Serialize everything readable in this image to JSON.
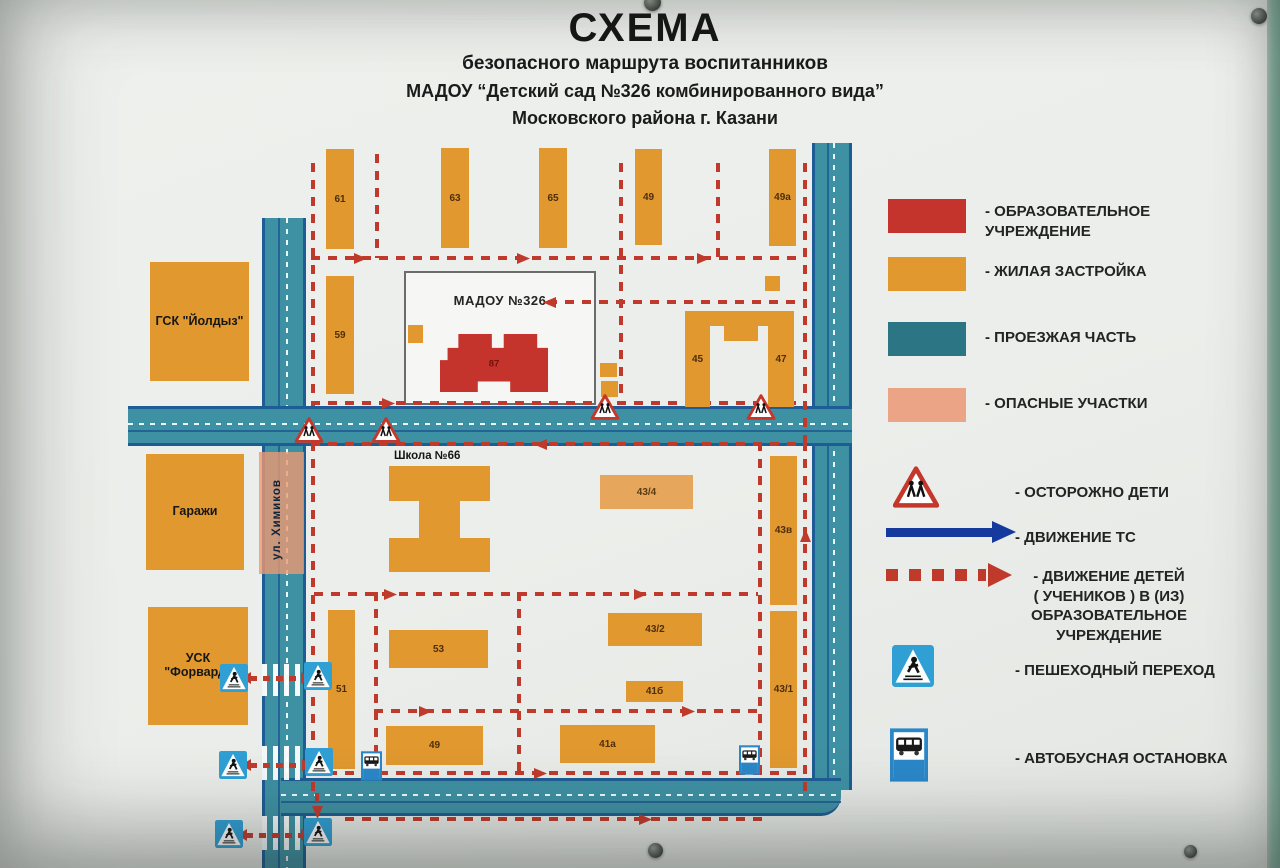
{
  "title": {
    "line1": "СХЕМА",
    "line2": "безопасного маршрута воспитанников",
    "line3": "МАДОУ “Детский сад №326 комбинированного вида”",
    "line4": "Московского района г. Казани"
  },
  "colors": {
    "education": "#c5342c",
    "residential": "#e0982f",
    "roadway": "#2b7584",
    "danger": "#eca487",
    "route_children": "#c03a2b",
    "vehicle_arrow": "#16399e",
    "road_fill": "#3e91a3",
    "road_edge": "#1d5c94",
    "sign_blue": "#2f9fd4"
  },
  "legend": {
    "items": [
      {
        "type": "swatch-education",
        "label": "- ОБРАЗОВАТЕЛЬНОЕ\nУЧРЕЖДЕНИЕ"
      },
      {
        "type": "swatch-residential",
        "label": "- ЖИЛАЯ ЗАСТРОЙКА"
      },
      {
        "type": "swatch-roadway",
        "label": "- ПРОЕЗЖАЯ ЧАСТЬ"
      },
      {
        "type": "swatch-danger",
        "label": "- ОПАСНЫЕ УЧАСТКИ"
      },
      {
        "type": "warn-sign",
        "label": "- ОСТОРОЖНО ДЕТИ"
      },
      {
        "type": "blue-arrow",
        "label": "- ДВИЖЕНИЕ ТС"
      },
      {
        "type": "red-dashed-arrow",
        "label": "- ДВИЖЕНИЕ ДЕТЕЙ\n( УЧЕНИКОВ ) В (ИЗ)\nОБРАЗОВАТЕЛЬНОЕ\nУЧРЕЖДЕНИЕ"
      },
      {
        "type": "pedestrian-sign",
        "label": "- ПЕШЕХОДНЫЙ ПЕРЕХОД"
      },
      {
        "type": "bus-sign",
        "label": "- АВТОБУСНАЯ ОСТАНОВКА"
      }
    ]
  },
  "map": {
    "street_label": "ул. Химиков",
    "madou_label": "МАДОУ №326",
    "madou_number": "87",
    "school_label": "Школа №66",
    "buildings": [
      {
        "label": "61",
        "x": 326,
        "y": 149,
        "w": 28,
        "h": 100
      },
      {
        "label": "63",
        "x": 441,
        "y": 148,
        "w": 28,
        "h": 100
      },
      {
        "label": "65",
        "x": 539,
        "y": 148,
        "w": 28,
        "h": 100
      },
      {
        "label": "49",
        "x": 635,
        "y": 149,
        "w": 27,
        "h": 96
      },
      {
        "label": "49а",
        "x": 769,
        "y": 149,
        "w": 27,
        "h": 97
      },
      {
        "label": "59",
        "x": 326,
        "y": 276,
        "w": 28,
        "h": 118
      },
      {
        "label": "45",
        "x": 685,
        "y": 311,
        "w": 25,
        "h": 96
      },
      {
        "label": "47",
        "x": 768,
        "y": 311,
        "w": 26,
        "h": 96
      },
      {
        "label": "",
        "x": 706,
        "y": 311,
        "w": 66,
        "h": 15
      },
      {
        "label": "",
        "x": 724,
        "y": 311,
        "w": 34,
        "h": 30
      },
      {
        "label": "ГСК \"Йолдыз\"",
        "x": 150,
        "y": 262,
        "w": 99,
        "h": 119,
        "kind": "big"
      },
      {
        "label": "Гаражи",
        "x": 146,
        "y": 454,
        "w": 98,
        "h": 116,
        "kind": "big"
      },
      {
        "label": "УСК \"Форвард\"",
        "x": 148,
        "y": 607,
        "w": 100,
        "h": 118,
        "kind": "big"
      },
      {
        "label": "",
        "x": 389,
        "y": 466,
        "w": 101,
        "h": 35
      },
      {
        "label": "",
        "x": 419,
        "y": 501,
        "w": 41,
        "h": 37
      },
      {
        "label": "",
        "x": 389,
        "y": 538,
        "w": 101,
        "h": 34
      },
      {
        "label": "43/4",
        "x": 600,
        "y": 475,
        "w": 93,
        "h": 34,
        "kind": "light"
      },
      {
        "label": "43в",
        "x": 770,
        "y": 456,
        "w": 27,
        "h": 149
      },
      {
        "label": "43/1",
        "x": 770,
        "y": 611,
        "w": 27,
        "h": 157
      },
      {
        "label": "51",
        "x": 328,
        "y": 610,
        "w": 27,
        "h": 159
      },
      {
        "label": "53",
        "x": 389,
        "y": 630,
        "w": 99,
        "h": 38
      },
      {
        "label": "49",
        "x": 386,
        "y": 726,
        "w": 97,
        "h": 39
      },
      {
        "label": "43/2",
        "x": 608,
        "y": 613,
        "w": 94,
        "h": 33
      },
      {
        "label": "41б",
        "x": 626,
        "y": 681,
        "w": 57,
        "h": 21
      },
      {
        "label": "41а",
        "x": 560,
        "y": 725,
        "w": 95,
        "h": 38
      },
      {
        "label": "",
        "x": 408,
        "y": 325,
        "w": 15,
        "h": 18
      },
      {
        "label": "",
        "x": 765,
        "y": 276,
        "w": 15,
        "h": 15
      },
      {
        "label": "",
        "x": 600,
        "y": 363,
        "w": 17,
        "h": 14
      },
      {
        "label": "",
        "x": 601,
        "y": 381,
        "w": 17,
        "h": 16
      }
    ],
    "routes": [
      {
        "d": "v",
        "x": 311,
        "y": 163,
        "len": 243
      },
      {
        "d": "v",
        "x": 375,
        "y": 154,
        "len": 104
      },
      {
        "d": "v",
        "x": 619,
        "y": 163,
        "len": 240
      },
      {
        "d": "v",
        "x": 716,
        "y": 163,
        "len": 95
      },
      {
        "d": "v",
        "x": 803,
        "y": 163,
        "len": 280
      },
      {
        "d": "h",
        "x": 311,
        "y": 256,
        "len": 493
      },
      {
        "d": "h",
        "x": 548,
        "y": 300,
        "len": 256
      },
      {
        "d": "h",
        "x": 311,
        "y": 401,
        "len": 493
      },
      {
        "d": "h",
        "x": 311,
        "y": 442,
        "len": 493
      },
      {
        "d": "v",
        "x": 311,
        "y": 442,
        "len": 352
      },
      {
        "d": "v",
        "x": 803,
        "y": 442,
        "len": 352
      },
      {
        "d": "v",
        "x": 758,
        "y": 442,
        "len": 330
      },
      {
        "d": "v",
        "x": 517,
        "y": 592,
        "len": 183
      },
      {
        "d": "v",
        "x": 374,
        "y": 592,
        "len": 181
      },
      {
        "d": "h",
        "x": 314,
        "y": 592,
        "len": 444
      },
      {
        "d": "h",
        "x": 374,
        "y": 709,
        "len": 384
      },
      {
        "d": "h",
        "x": 311,
        "y": 771,
        "len": 493
      },
      {
        "d": "h",
        "x": 345,
        "y": 817,
        "len": 420
      },
      {
        "d": "v",
        "x": 315,
        "y": 793,
        "len": 16
      }
    ],
    "route_arrows": [
      {
        "x": 360,
        "y": 258,
        "dir": "right"
      },
      {
        "x": 523,
        "y": 258,
        "dir": "right"
      },
      {
        "x": 703,
        "y": 258,
        "dir": "right"
      },
      {
        "x": 549,
        "y": 302,
        "dir": "left"
      },
      {
        "x": 388,
        "y": 403,
        "dir": "right"
      },
      {
        "x": 540,
        "y": 444,
        "dir": "left"
      },
      {
        "x": 390,
        "y": 594,
        "dir": "right"
      },
      {
        "x": 640,
        "y": 594,
        "dir": "right"
      },
      {
        "x": 425,
        "y": 711,
        "dir": "right"
      },
      {
        "x": 688,
        "y": 711,
        "dir": "right"
      },
      {
        "x": 540,
        "y": 773,
        "dir": "right"
      },
      {
        "x": 645,
        "y": 819,
        "dir": "right"
      },
      {
        "x": 805,
        "y": 535,
        "dir": "up"
      },
      {
        "x": 317,
        "y": 812,
        "dir": "down"
      }
    ],
    "crossing_arrows": [
      {
        "x": 250,
        "y": 676,
        "w": 52
      },
      {
        "x": 250,
        "y": 763,
        "w": 53
      },
      {
        "x": 246,
        "y": 833,
        "w": 56
      }
    ],
    "zebras": [
      {
        "x": 262,
        "y": 664,
        "w": 38,
        "h": 32
      },
      {
        "x": 262,
        "y": 746,
        "w": 38,
        "h": 34
      },
      {
        "x": 262,
        "y": 816,
        "w": 38,
        "h": 34
      }
    ],
    "signs": [
      {
        "t": "ped",
        "x": 220,
        "y": 664
      },
      {
        "t": "ped",
        "x": 304,
        "y": 662
      },
      {
        "t": "ped",
        "x": 219,
        "y": 751
      },
      {
        "t": "ped",
        "x": 305,
        "y": 748
      },
      {
        "t": "ped",
        "x": 215,
        "y": 820
      },
      {
        "t": "ped",
        "x": 304,
        "y": 818
      },
      {
        "t": "bus",
        "x": 361,
        "y": 751
      },
      {
        "t": "bus",
        "x": 739,
        "y": 745
      },
      {
        "t": "warn",
        "x": 294,
        "y": 417
      },
      {
        "t": "warn",
        "x": 371,
        "y": 417
      },
      {
        "t": "warn",
        "x": 590,
        "y": 394
      },
      {
        "t": "warn",
        "x": 746,
        "y": 394
      }
    ],
    "bolts": [
      {
        "x": 644,
        "y": -6,
        "r": 17
      },
      {
        "x": 1251,
        "y": 8,
        "r": 16
      },
      {
        "x": 648,
        "y": 843,
        "r": 15
      },
      {
        "x": 1184,
        "y": 845,
        "r": 13
      }
    ]
  }
}
